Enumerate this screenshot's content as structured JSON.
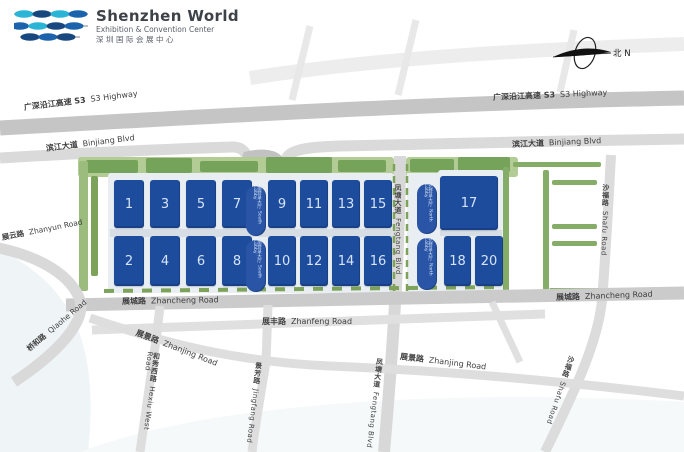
{
  "header": {
    "title": "Shenzhen World",
    "subtitle_en": "Exhibition & Convention Center",
    "subtitle_cn": "深圳国际会展中心"
  },
  "compass": {
    "label": "北 N"
  },
  "halls": {
    "h1": "1",
    "h2": "2",
    "h3": "3",
    "h4": "4",
    "h5": "5",
    "h6": "6",
    "h7": "7",
    "h8": "8",
    "h9": "9",
    "h10": "10",
    "h11": "11",
    "h12": "12",
    "h13": "13",
    "h14": "14",
    "h15": "15",
    "h16": "16",
    "h17": "17",
    "h18": "18",
    "h20": "20"
  },
  "lobbies": {
    "south_cn": "南登录大厅",
    "south_en": "South Lobby",
    "north_cn": "北登录大厅",
    "north_en": "North Lobby"
  },
  "roads": {
    "s3_cn": "广深沿江高速 S3",
    "s3_en": "S3 Highway",
    "binjiang_cn": "滨江大道",
    "binjiang_en": "Binjiang Blvd",
    "zhanyun_cn": "展云路",
    "zhanyun_en": "Zhanyun Road",
    "qiaohe_cn": "桥和路",
    "qiaohe_en": "Qiaohe Road",
    "zhancheng_cn": "展城路",
    "zhancheng_en": "Zhancheng Road",
    "zhanfeng_cn": "展丰路",
    "zhanfeng_en": "Zhanfeng Road",
    "zhanjing_cn": "展景路",
    "zhanjing_en": "Zhanjing Road",
    "hexiu_cn": "和秀西路",
    "hexiu_en": "Hexiu West Road",
    "jingfang_cn": "景芳路",
    "jingfang_en": "Jingfang Road",
    "fengtang_cn": "凤塘大道",
    "fengtang_en": "Fengtang Blvd",
    "shafu_cn": "沙福路",
    "shafu_en": "Shafu Road"
  },
  "colors": {
    "hall_blue": "#1e4c9d",
    "lobby_blue": "#2a55a6",
    "road_gray": "#c9c9c9",
    "green": "#76a35a",
    "logo_cyan": "#2ab5d6",
    "logo_blue": "#1b63ac",
    "logo_navy": "#16477e"
  }
}
